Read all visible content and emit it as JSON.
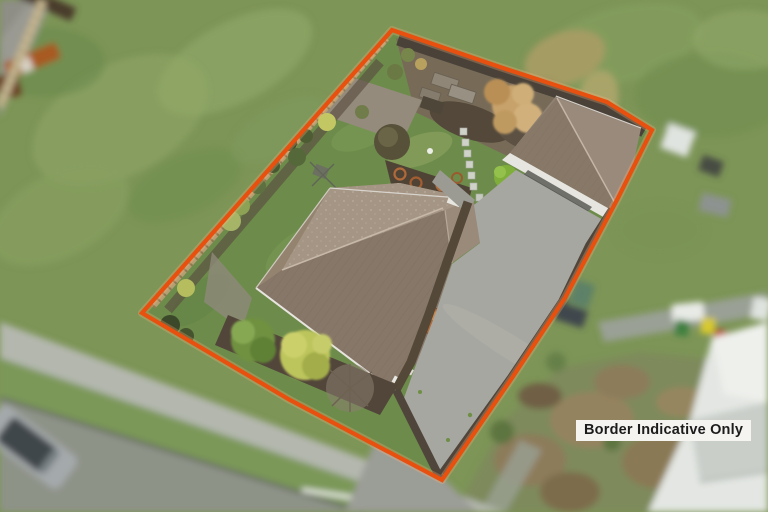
{
  "image": {
    "type": "aerial-property-photo",
    "width": 768,
    "height": 512,
    "description": "Aerial drone photograph of a residential property; surroundings are tilt-shift blurred, property boundary drawn as an orange polygon overlay"
  },
  "overlay": {
    "border_color": "#e8500f",
    "border_glow": "#ffb27a",
    "border_points": "392,30 500,67 607,102 652,130 618,198 565,298 512,378 442,480 290,400 142,313",
    "label": {
      "text": "Border Indicative Only",
      "background": "#f6f4f0",
      "text_color": "#1c1c1c"
    }
  },
  "scene": {
    "palette": {
      "lawn": "#6d8c4b",
      "blurred_lawn": "#7d9557",
      "house_roof": "#94846f",
      "garage_roof": "#8f8173",
      "driveway_concrete": "#a6a7a1",
      "gravel_bed": "#52463a",
      "street": "#8e9388",
      "footpath": "#b4b7ae",
      "wood_fence": "#b49e74",
      "chimney_brick": "#b06a38",
      "dead_tree": "#c7a26b",
      "yellow_green_tree": "#bcc45c"
    },
    "objects": [
      "house-with-brown-roof",
      "detached-garage",
      "long-gravel-driveway",
      "back-lawn",
      "vegetable-garden-beds",
      "stepping-stone-path",
      "front-garden-shrubs",
      "timber-boundary-fence",
      "street-with-parked-car",
      "footpath-and-grass-verge",
      "neighbor-gardens",
      "wheelie-bins",
      "neighbor-buildings"
    ]
  }
}
